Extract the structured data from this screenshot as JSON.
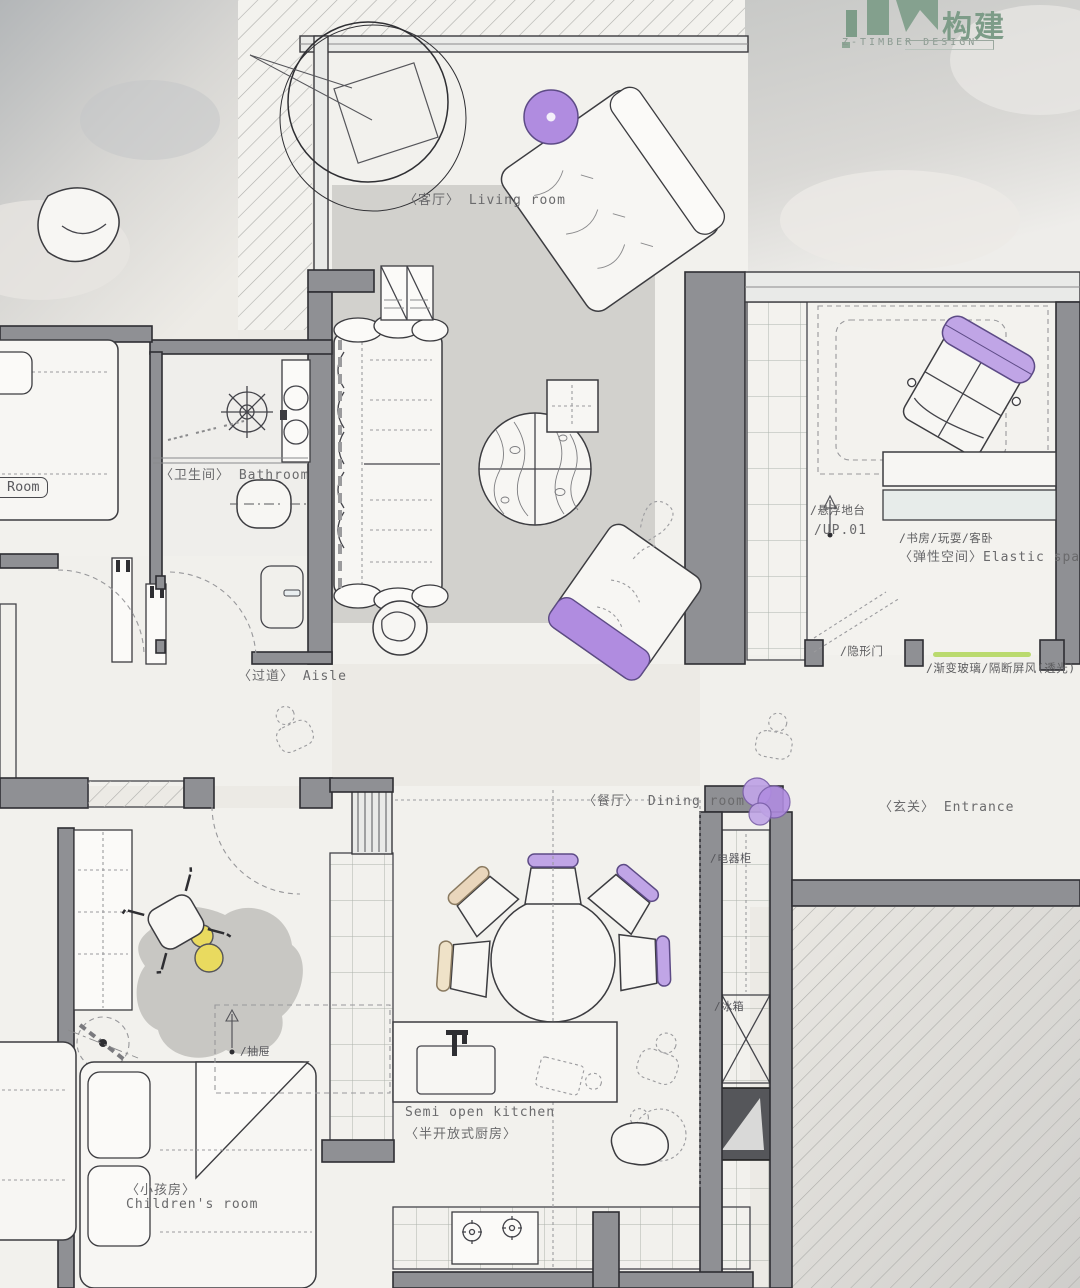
{
  "logo": {
    "cn": "构建",
    "en": "Z-TIMBER DESIGN"
  },
  "rooms": {
    "living": "〈客厅〉 Living room",
    "bathroom": "〈卫生间〉 Bathroom",
    "aisle": "〈过道〉 Aisle",
    "dining": "〈餐厅〉 Dining room",
    "entrance": "〈玄关〉 Entrance",
    "kitchen_en": "Semi open kitchen",
    "kitchen_cn": "〈半开放式厨房〉",
    "children_cn": "〈小孩房〉",
    "children_en": "Children's room",
    "elastic_uses": "/书房/玩耍/客卧",
    "elastic": "〈弹性空间〉Elastic space",
    "partial_room": "Room"
  },
  "annotations": {
    "floating_platform": "/悬浮地台",
    "up_level": "/UP.01",
    "hidden_door": "/隐形门",
    "glass_partition": "/渐变玻璃/隔断屏风(透光)",
    "appliance_cabinet": "/电器柜",
    "fridge": "/冰箱",
    "drawer": "/抽屉"
  },
  "colors": {
    "purple": "#b08ce0",
    "purple_light": "#c0a5e6",
    "sage": "#b4c0b8",
    "beige": "#e9d6bc",
    "cream": "#efe2c8",
    "yellow": "#e9da5f",
    "glass_green": "#bada6e",
    "wall_gray": "#8f9094",
    "rug_gray": "#d2d1cd",
    "sink_blue": "#d3e2e7",
    "logo_green": "#7d9c88"
  }
}
